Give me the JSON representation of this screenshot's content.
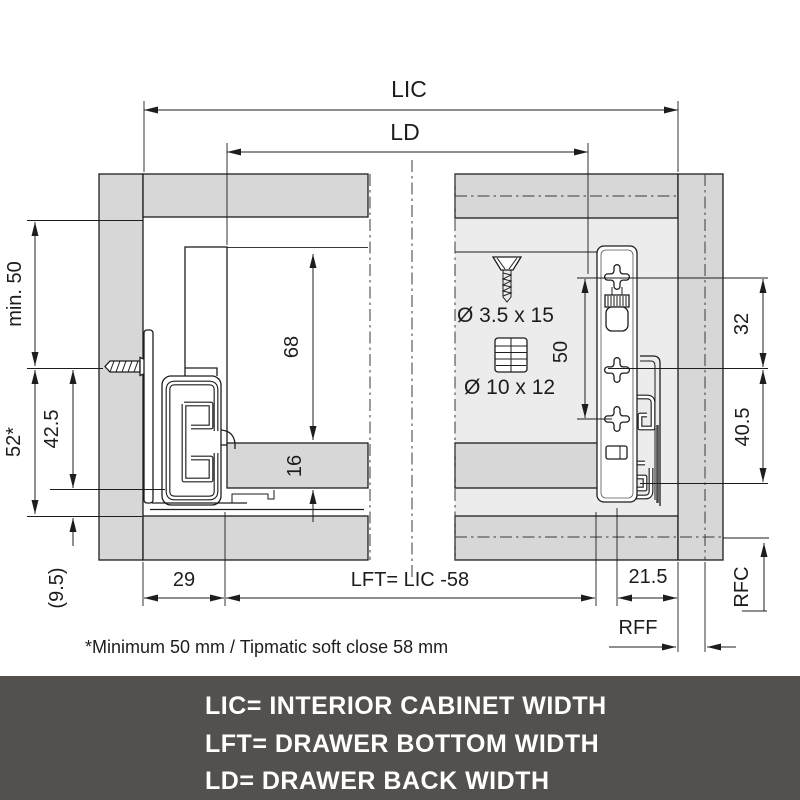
{
  "drawing": {
    "dims": {
      "lic": "LIC",
      "ld": "LD",
      "min50": "min. 50",
      "d52": "52*",
      "d42_5": "42.5",
      "d9_5": "(9.5)",
      "d68": "68",
      "d16": "16",
      "d29": "29",
      "lft": "LFT= LIC -58",
      "d50": "50",
      "d32": "32",
      "d40_5": "40.5",
      "d21_5": "21.5",
      "rff": "RFF",
      "rfc": "RFC"
    },
    "hardware": {
      "screw": "Ø 3.5 x 15",
      "dowel": "Ø 10 x 12"
    },
    "footnote": "*Minimum 50 mm / Tipmatic soft close 58 mm",
    "colors": {
      "panel": "#d7d7d7",
      "panel_light": "#ececec",
      "line": "#1d1d1b",
      "legend_bg": "#53504d",
      "legend_text": "#ffffff"
    }
  },
  "legend": {
    "lines": [
      "LIC= INTERIOR CABINET WIDTH",
      "LFT= DRAWER BOTTOM WIDTH",
      "LD= DRAWER BACK WIDTH"
    ]
  }
}
